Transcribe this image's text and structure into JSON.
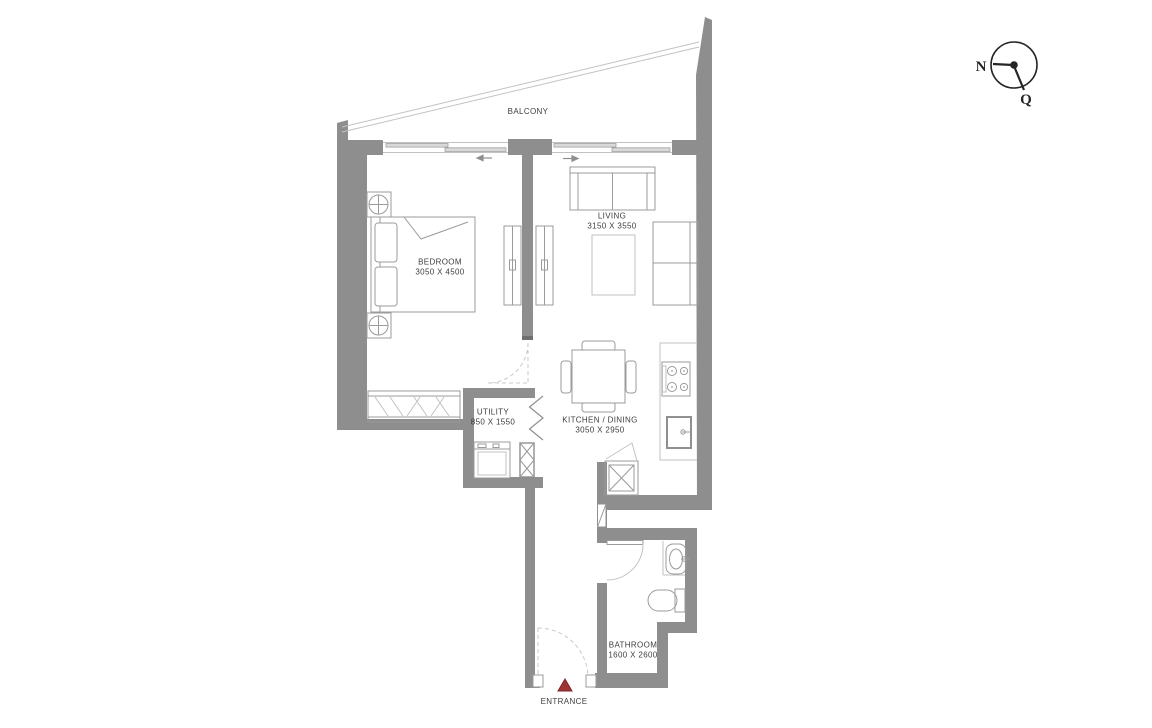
{
  "rooms": {
    "balcony": {
      "name": "BALCONY",
      "dims": ""
    },
    "bedroom": {
      "name": "BEDROOM",
      "dims": "3050 X 4500"
    },
    "living": {
      "name": "LIVING",
      "dims": "3150 X 3550"
    },
    "utility": {
      "name": "UTILITY",
      "dims": "850 X 1550"
    },
    "kitchen_dining": {
      "name": "KITCHEN / DINING",
      "dims": "3050 X 2950"
    },
    "bathroom": {
      "name": "BATHROOM",
      "dims": "1600 X 2600"
    },
    "entrance": {
      "name": "ENTRANCE",
      "dims": ""
    }
  },
  "compass": {
    "labels": [
      "N",
      "Q"
    ]
  },
  "colors": {
    "wall": "#8e8e8e",
    "wall_dark": "#6f6f6f",
    "furniture_line": "#9b9b9b",
    "light_line": "#c2c2c2",
    "text": "#3d3d3d",
    "entrance_marker": "#9e3434",
    "compass": "#262626",
    "background": "#ffffff"
  }
}
